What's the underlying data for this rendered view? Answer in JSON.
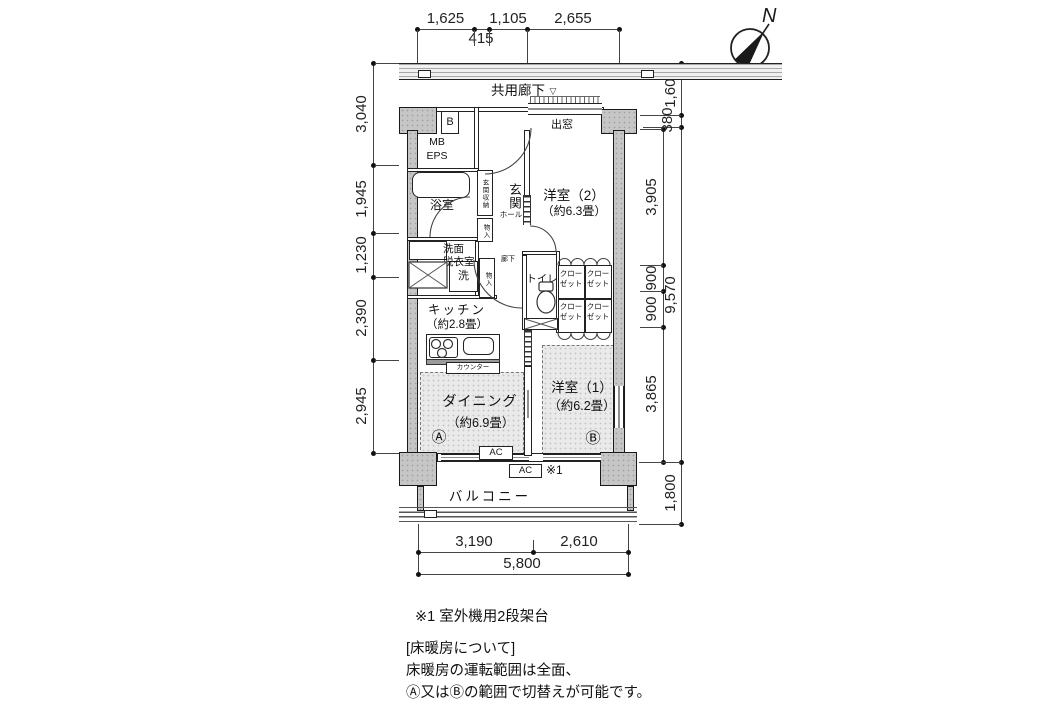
{
  "compass": {
    "label": "N"
  },
  "corridor": {
    "label": "共用廊下"
  },
  "balcony": {
    "label": "バルコニー"
  },
  "dims": {
    "top1": [
      "1,625",
      "1,105",
      "2,655"
    ],
    "top2": "415",
    "left": [
      "3,040",
      "1,945",
      "1,230",
      "2,390",
      "2,945"
    ],
    "right_inner": [
      "3,905",
      "900",
      "900",
      "3,865"
    ],
    "right_outer": [
      "1,600",
      "380",
      "9,570",
      "1,800"
    ],
    "bottom1": [
      "3,190",
      "2,610"
    ],
    "bottom2": "5,800"
  },
  "rooms": {
    "western2_name": "洋室（2）",
    "western2_size": "（約6.3畳）",
    "western1_name": "洋室（1）",
    "western1_size": "（約6.2畳）",
    "dining_name": "ダイニング",
    "dining_size": "（約6.9畳）",
    "kitchen_name": "キッチン",
    "kitchen_size": "（約2.8畳）",
    "bath": "浴室",
    "washroom1": "洗面",
    "washroom2": "脱衣室",
    "toilet": "トイレ",
    "entrance": "玄関",
    "hall": "ホール",
    "hallway": "廊下",
    "entrance_storage": "玄関収納",
    "storage": "物入",
    "closet1": "クロー",
    "closet2": "ゼット",
    "bay_window": "出窓",
    "mb": "MB",
    "eps": "EPS",
    "meter_box": "B",
    "washer": "洗",
    "counter": "カウンター"
  },
  "markers": {
    "zone_a": "Ⓐ",
    "zone_b": "Ⓑ",
    "ac": "AC",
    "note_ref": "※1",
    "entry": "▽"
  },
  "notes": {
    "note1": "※1 室外機用2段架台",
    "heading": "[床暖房について]",
    "line1": "床暖房の運転範囲は全面、",
    "line2": "Ⓐ又はⒷの範囲で切替えが可能です。"
  }
}
